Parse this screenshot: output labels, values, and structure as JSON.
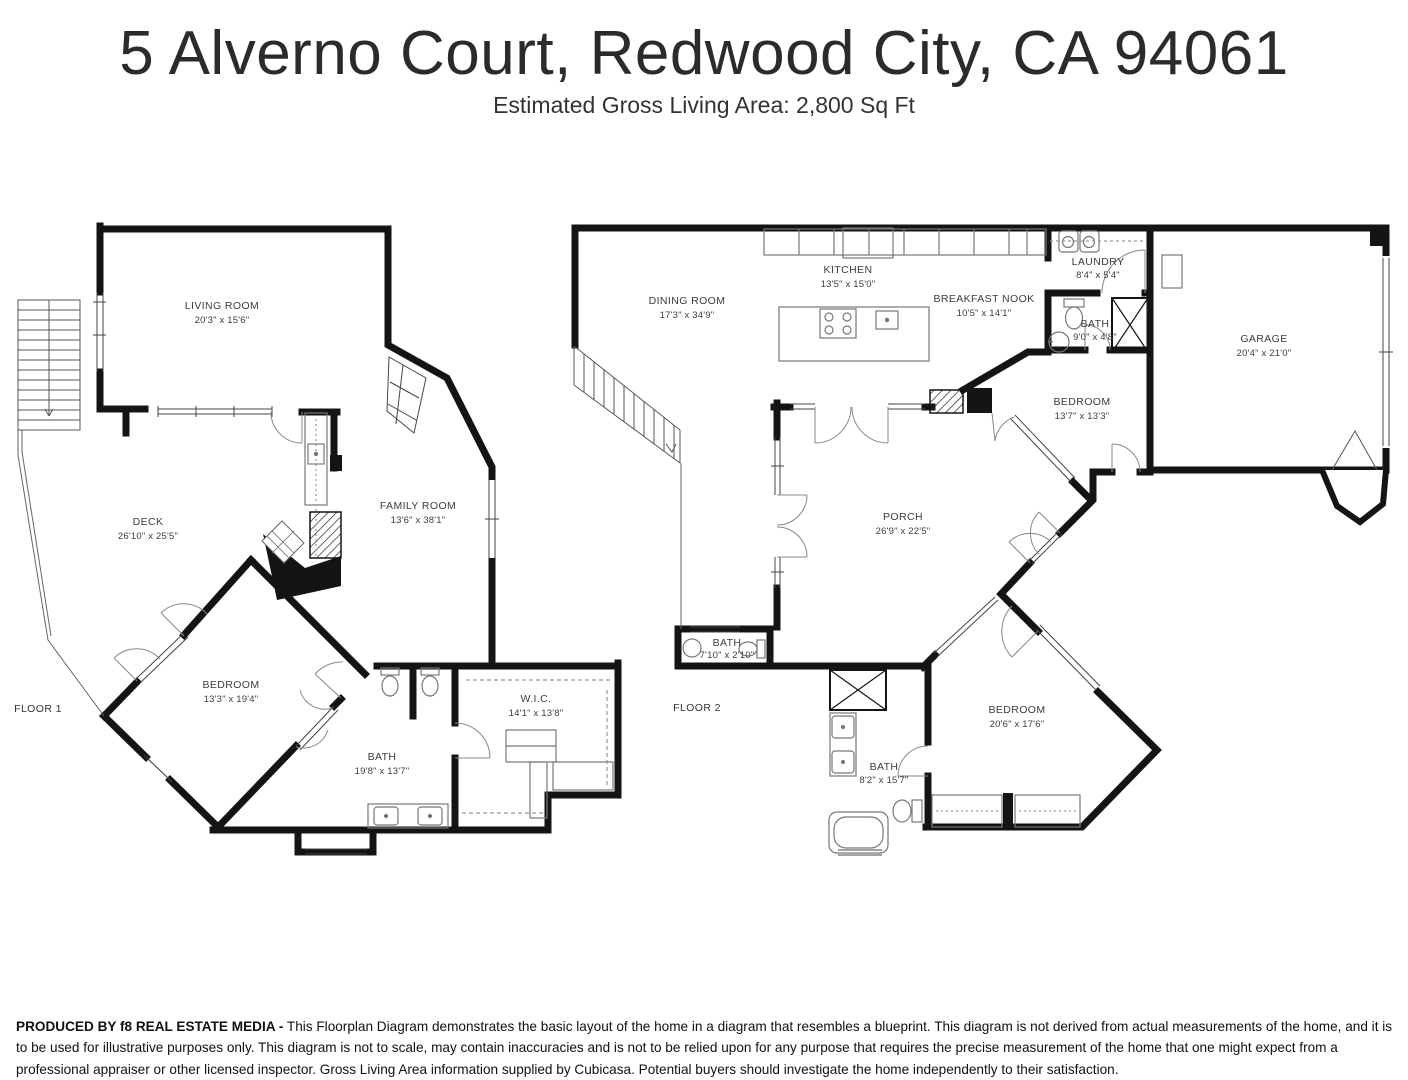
{
  "header": {
    "title": "5 Alverno Court, Redwood City, CA 94061",
    "subtitle": "Estimated Gross Living Area: 2,800 Sq Ft"
  },
  "floor1": {
    "label": "FLOOR 1",
    "rooms": [
      {
        "name": "LIVING ROOM",
        "dims": "20'3\" x 15'6\""
      },
      {
        "name": "DECK",
        "dims": "26'10\" x 25'5\""
      },
      {
        "name": "FAMILY ROOM",
        "dims": "13'6\" x 38'1\""
      },
      {
        "name": "BEDROOM",
        "dims": "13'3\" x 19'4\""
      },
      {
        "name": "BATH",
        "dims": "19'8\" x 13'7\""
      },
      {
        "name": "W.I.C.",
        "dims": "14'1\" x 13'8\""
      }
    ]
  },
  "floor2": {
    "label": "FLOOR 2",
    "rooms": [
      {
        "name": "DINING ROOM",
        "dims": "17'3\" x 34'9\""
      },
      {
        "name": "KITCHEN",
        "dims": "13'5\" x 15'0\""
      },
      {
        "name": "BREAKFAST NOOK",
        "dims": "10'5\" x 14'1\""
      },
      {
        "name": "LAUNDRY",
        "dims": "8'4\" x 5'4\""
      },
      {
        "name": "BATH",
        "dims": "9'0\" x 4'8\""
      },
      {
        "name": "GARAGE",
        "dims": "20'4\" x 21'0\""
      },
      {
        "name": "BEDROOM",
        "dims": "13'7\" x 13'3\""
      },
      {
        "name": "PORCH",
        "dims": "26'9\" x 22'5\""
      },
      {
        "name": "BATH",
        "dims": "7'10\" x 2'10\""
      },
      {
        "name": "BEDROOM",
        "dims": "20'6\" x 17'6\""
      },
      {
        "name": "BATH",
        "dims": "8'2\" x 15'7\""
      }
    ]
  },
  "footer": {
    "produced_by": "PRODUCED BY f8 REAL ESTATE MEDIA -",
    "disclaimer": "This Floorplan Diagram demonstrates the basic layout of the home in a diagram that resembles a blueprint. This diagram is not derived from actual measurements of the home, and it is to be used for illustrative purposes only. This diagram is not to scale, may contain inaccuracies and is not to be relied upon for any purpose that requires the precise measurement of the home that one might expect from a professional appraiser or other licensed inspector. Gross Living Area information supplied by Cubicasa. Potential buyers should investigate the home independently to their satisfaction."
  },
  "colors": {
    "wall": "#141414",
    "fixture": "#777777",
    "label": "#3c3c3c"
  }
}
